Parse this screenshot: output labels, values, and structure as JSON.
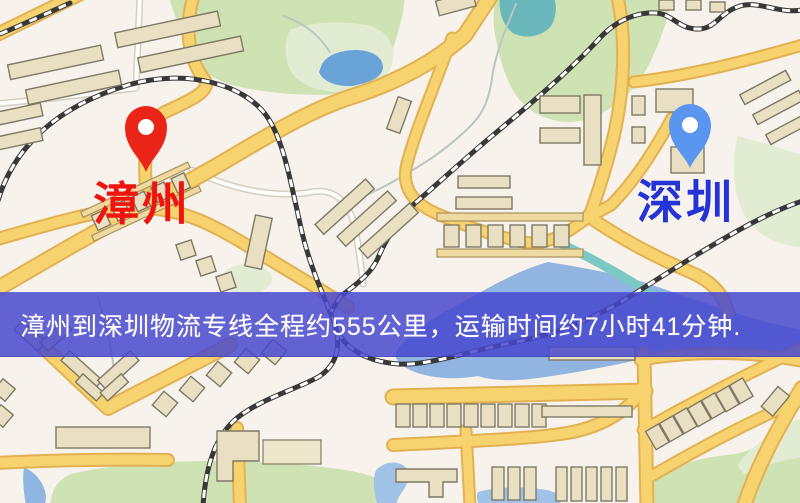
{
  "route_banner": {
    "text": "漳州到深圳物流专线全程约555公里，运输时间约7小时41分钟.",
    "origin": "漳州",
    "destination": "深圳",
    "distance": "约555公里",
    "duration": "约7小时41分钟",
    "background_color": "rgba(70,70,206,0.84)",
    "text_color": "#ffffff"
  },
  "markers": {
    "origin": {
      "label": "漳州",
      "pin_color": "#ea2417",
      "pin_inner_color": "#ffffff",
      "label_color": "#f0140e"
    },
    "destination": {
      "label": "深圳",
      "pin_color": "#5a95ef",
      "pin_inner_color": "#ffffff",
      "label_color": "#2433d6"
    }
  },
  "map_palette": {
    "background": "#f7f2ec",
    "park": "#cfe2b3",
    "park_pale": "#e2ecd2",
    "lake_water": "#6aa3d8",
    "open_water": "#92b4e0",
    "teal_river": "#7cc8c4",
    "road_major": "#f7d36f",
    "road_casing": "#e2b152",
    "road_minor": "#fdfdf9",
    "railway": "#383838",
    "building_fill": "#e9e0c3",
    "building_outline": "#7e7965"
  }
}
